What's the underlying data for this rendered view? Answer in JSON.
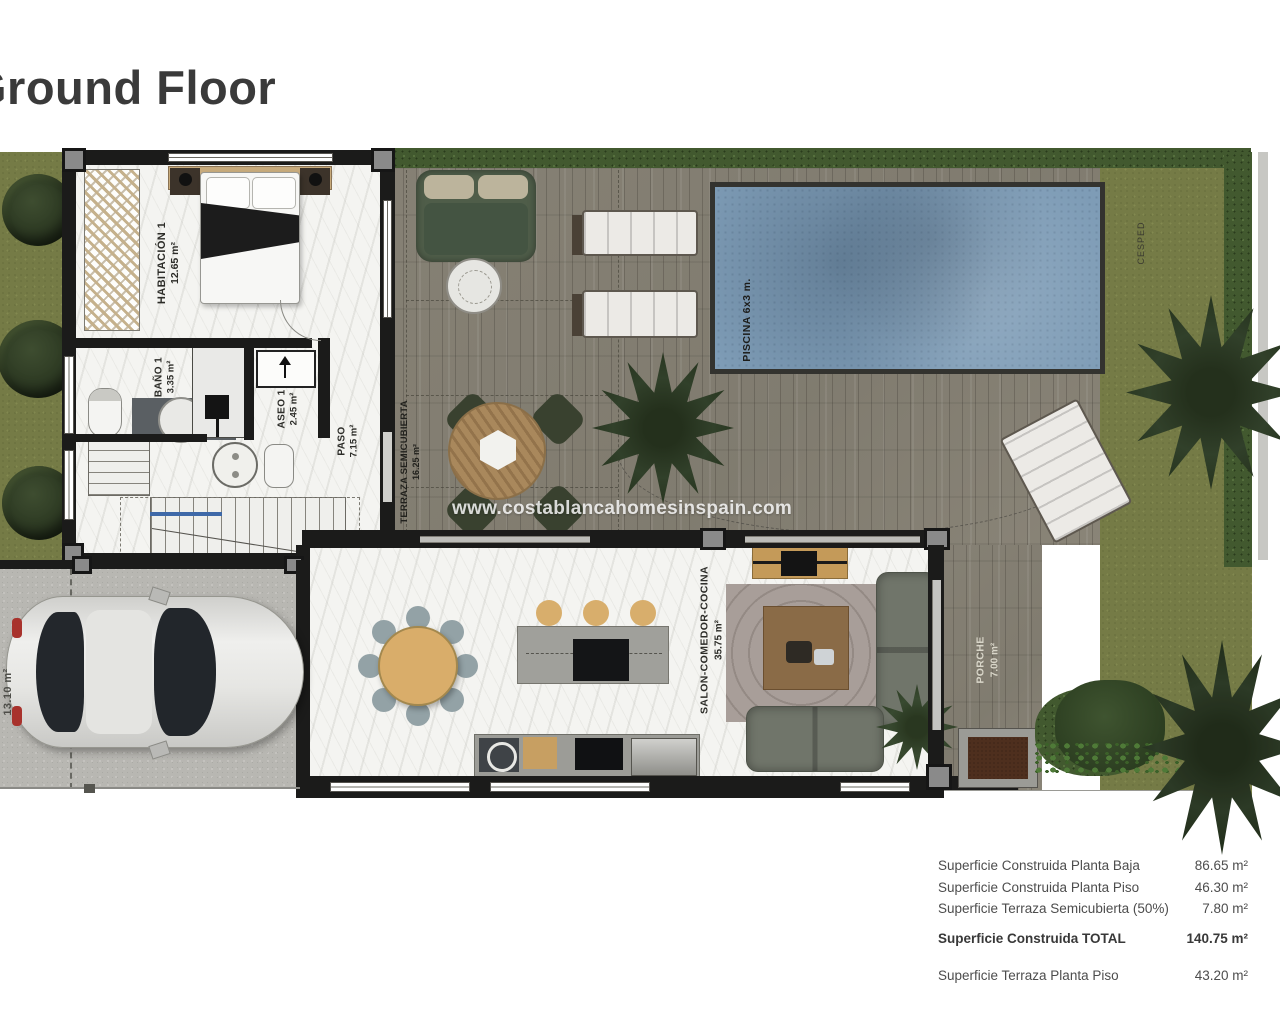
{
  "title": "Ground Floor",
  "watermark": "www.costablancahomesinspain.com",
  "rooms": {
    "habitacion1": {
      "name": "HABITACIÓN 1",
      "area": "12.65 m²"
    },
    "bano1": {
      "name": "BAÑO 1",
      "area": "3.35 m²"
    },
    "aseo1": {
      "name": "ASEO 1",
      "area": "2.45 m²"
    },
    "paso": {
      "name": "PASO",
      "area": "7.15 m²"
    },
    "terraza": {
      "name": "TERRAZA SEMICUBIERTA",
      "area": "16.25 m²"
    },
    "salon": {
      "name": "SALON-COMEDOR-COCINA",
      "area": "35.75 m²"
    },
    "porche": {
      "name": "PORCHE",
      "area": "7.00 m²"
    },
    "piscina": {
      "name": "PISCINA 6x3 m."
    },
    "parking": {
      "area": "13.10 m²"
    },
    "cesped": {
      "name": "CESPED"
    }
  },
  "summary": {
    "rows": [
      {
        "label": "Superficie Construida Planta Baja",
        "value": "86.65 m²"
      },
      {
        "label": "Superficie Construida Planta Piso",
        "value": "46.30 m²"
      },
      {
        "label": "Superficie Terraza Semicubierta (50%)",
        "value": "7.80 m²"
      },
      {
        "label": "Superficie Construida TOTAL",
        "value": "140.75 m²"
      },
      {
        "label": "Superficie Terraza Planta Piso",
        "value": "43.20 m²"
      }
    ]
  },
  "colors": {
    "wall": "#1b1b1a",
    "deck": "#8d887b",
    "pool": "#7e9cb6",
    "grass": "#757b46",
    "hedge": "#42592f",
    "concrete": "#b8b7b2"
  }
}
